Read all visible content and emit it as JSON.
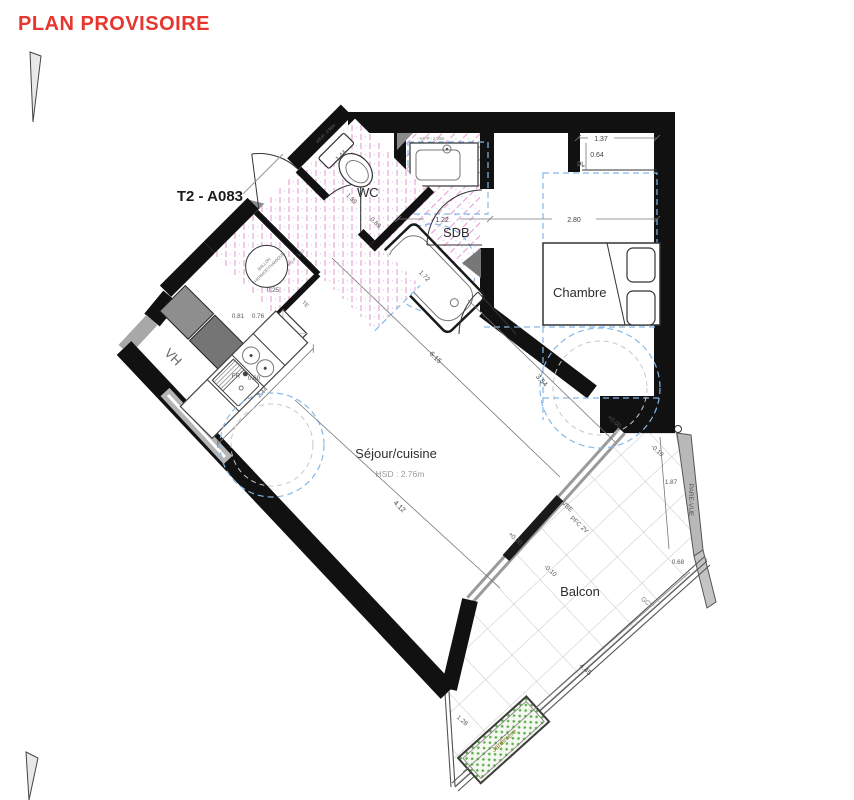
{
  "stamp": {
    "text": "PLAN PROVISOIRE",
    "color": "#e8352e"
  },
  "unit": {
    "label": "T2 - A083"
  },
  "rooms": {
    "wc": "WC",
    "sdb": "SDB",
    "chambre": "Chambre",
    "sejour": "Séjour/cuisine",
    "sejour_height": "HSD : 2.76m",
    "balcon": "Balcon"
  },
  "equipment": {
    "ballon_line1": "BALLON",
    "ballon_line2": "THERMODYNAMIQUE",
    "ll": "LL",
    "fr": "FR",
    "te": "TE",
    "vh": "VH",
    "pl": "PL",
    "jardiniere": "Jardinière",
    "pare_vue": "PARE-VUE",
    "gcv": "GCV",
    "vbe": "VBE",
    "pfc": "PFC 2V"
  },
  "levels": {
    "sejour": "+0.00",
    "balcon": "-0.10"
  },
  "dimensions": {
    "d_137": "1.37",
    "d_064": "0.64",
    "d_280": "2.80",
    "d_122": "1.22",
    "d_144": "1.44",
    "d_139": "1.39",
    "d_089": "0.89",
    "d_025": "0.25",
    "d_081": "0.81",
    "d_076": "0.76",
    "d_060": "0.60",
    "d_244": "2.44",
    "d_172": "1.72",
    "d_615": "6.15",
    "d_412": "4.12",
    "d_354": "3.54",
    "d_187": "1.87",
    "d_068": "0.68",
    "d_445": "4.45",
    "d_128": "1.28"
  },
  "annotations": {
    "hsp_entry": "HS-P : 1.53",
    "hsp_wc": "HS-P : 2.50m"
  },
  "colors": {
    "wall": "#111111",
    "hatch_pink": "#e79fd3",
    "dash_blue": "#85b8e8",
    "tile_line": "#c6c6c6",
    "planter_green": "#5aae4a",
    "duct_gray": "#8e8e8e"
  }
}
